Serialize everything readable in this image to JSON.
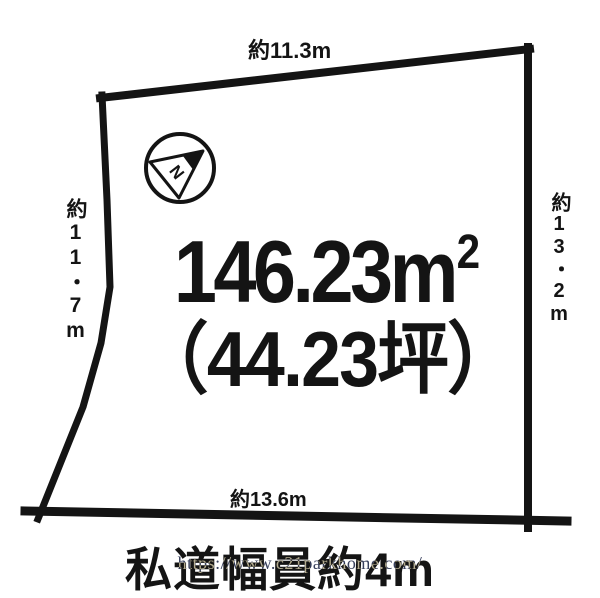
{
  "theme": {
    "bg": "#ffffff",
    "ink": "#141414",
    "watermark": "rgb(198,190,162)"
  },
  "diagram": {
    "type": "land-plot-outline",
    "dimensions": {
      "top": "約11.3m",
      "left": "約11・7m",
      "right": "約13・2m",
      "bottom": "約13.6m"
    },
    "area": {
      "value": "146.23m",
      "sup": "2",
      "tsubo": "（44.23坪）"
    },
    "road_note": "私道幅員約4m",
    "compass": {
      "icon": "compass-north-arrow-icon",
      "label": "N"
    }
  },
  "watermark": "https://www.c21parkhome.com/"
}
